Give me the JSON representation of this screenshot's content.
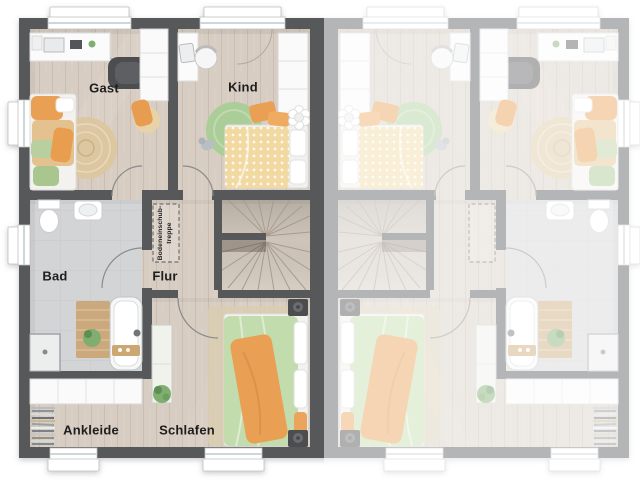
{
  "floorplan": {
    "labels": {
      "gast": "Gast",
      "kind": "Kind",
      "bad": "Bad",
      "flur": "Flur",
      "ankleide": "Ankleide",
      "schlafen": "Schlafen"
    },
    "loft_stairs": {
      "line1": "Bodeneinschub-",
      "line2": "treppe"
    }
  },
  "colors": {
    "wall": "#57585a",
    "floor_wood": "#d7cdc2",
    "floor_bad": "#d3d4d6",
    "floor_stairs": "#d2c8bd",
    "rug_jute": "#dcc7a0",
    "rug_green": "#abcd97",
    "rug_beige": "#d9ccb2",
    "accent_orange": "#e9a055",
    "accent_green": "#c3dcae",
    "accent_yellow": "#f1d9a1",
    "white_furniture": "#fafafa",
    "wood_furniture": "#cba97c",
    "dark_furniture": "#4c4d4f",
    "plant_green": "#7fae6f",
    "overlay_white": "#ffffff"
  }
}
